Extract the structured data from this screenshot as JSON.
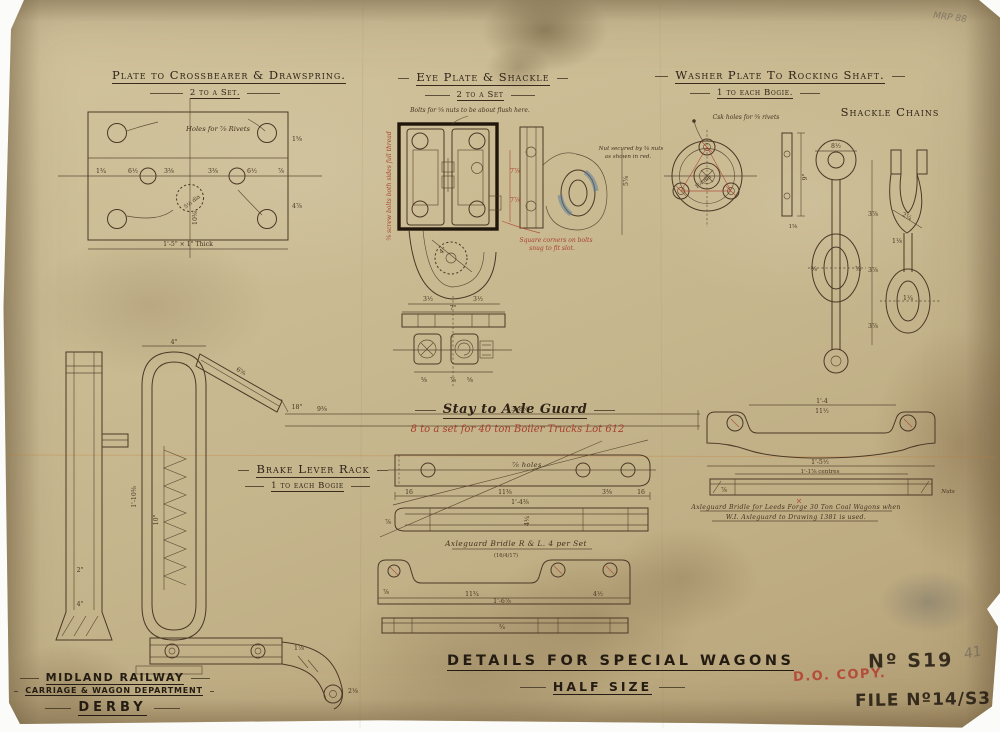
{
  "sections": {
    "plate": {
      "title": "Plate to Crossbearer & Drawspring.",
      "sub": "2 to a Set.",
      "note": "Holes for ⅞ Rivets",
      "bottom_dim": "1'-5\" × 1\" Thick",
      "dims": [
        "1¾",
        "6½",
        "3⅜",
        "3⅜",
        "6½",
        "⅞",
        "10⅜",
        "1⅝",
        "4⅞",
        "5½ dia"
      ]
    },
    "eye": {
      "title": "Eye Plate & Shackle",
      "sub": "2 to a Set",
      "note_top": "Bolts for ⅝ nuts to be about flush here.",
      "note_left": "⅝ screw bolts both sides full thread",
      "note_right1": "Nut secured by ⅝ nuts",
      "note_right2": "as shown in red.",
      "note_sq1": "Square corners on bolts",
      "note_sq2": "snug to fit slot.",
      "dims": [
        "4\"",
        "7⅞",
        "7⅞",
        "5⅞"
      ],
      "top_view": {
        "dims": [
          "3½",
          "3½",
          "7\"",
          "⅝",
          "⅞",
          "⅝"
        ]
      }
    },
    "washer": {
      "title": "Washer Plate To Rocking Shaft.",
      "sub": "1 to each Bogie.",
      "note": "Csk holes for ⅝ rivets",
      "dims": [
        "9\"",
        "1¼ dia",
        "1⅝"
      ]
    },
    "chains": {
      "title": "Shackle Chains",
      "dims": [
        "8½",
        "3⅞",
        "3⅞",
        "3⅞",
        "2¼",
        "⅝",
        "⅞",
        "1¼",
        "1⅛"
      ]
    },
    "brake": {
      "title": "Brake Lever Rack",
      "sub": "1 to each Bogie",
      "dims": [
        "4\"",
        "1'-10⅜",
        "10\"",
        "18\"",
        "6⅝",
        "9⅜",
        "3'-8½",
        "2\"",
        "4\"",
        "1⅞",
        "2⅛"
      ]
    },
    "stay": {
      "title": "Stay to Axle Guard",
      "sub": "8 to a set for 40 ton Boiler Trucks Lot 612",
      "note": "⅞ holes",
      "dims": [
        "16",
        "11⅜",
        "3⅜",
        "16",
        "1'-4⅜",
        "4¼",
        "⅞"
      ]
    },
    "bridle_mid": {
      "label": "Axleguard Bridle   R & L. 4 per Set",
      "date": "(16/4/17)",
      "dims": [
        "11¾",
        "1'-6⅞",
        "4½",
        "⅞",
        "¾"
      ]
    },
    "bridle_right": {
      "note1": "Axleguard Bridle for Leeds Forge 30 Ton Coal Wagons when",
      "note2": "W.I. Axleguard to Drawing 1381 is used.",
      "dims": [
        "1'-4",
        "11½",
        "1'-5½",
        "1'-1⅞ centres",
        "⅞",
        "Nuts"
      ]
    }
  },
  "title_block": {
    "company": "MIDLAND RAILWAY",
    "department": "CARRIAGE & WAGON DEPARTMENT",
    "location": "DERBY",
    "drawing_title": "DETAILS FOR SPECIAL WAGONS",
    "scale": "HALF SIZE",
    "stamp": "D.O. COPY.",
    "number": "Nº S19",
    "file": "FILE Nº14/S3"
  },
  "corner": {
    "pencil_ref": "MRP 88",
    "pencil_num": "41"
  }
}
